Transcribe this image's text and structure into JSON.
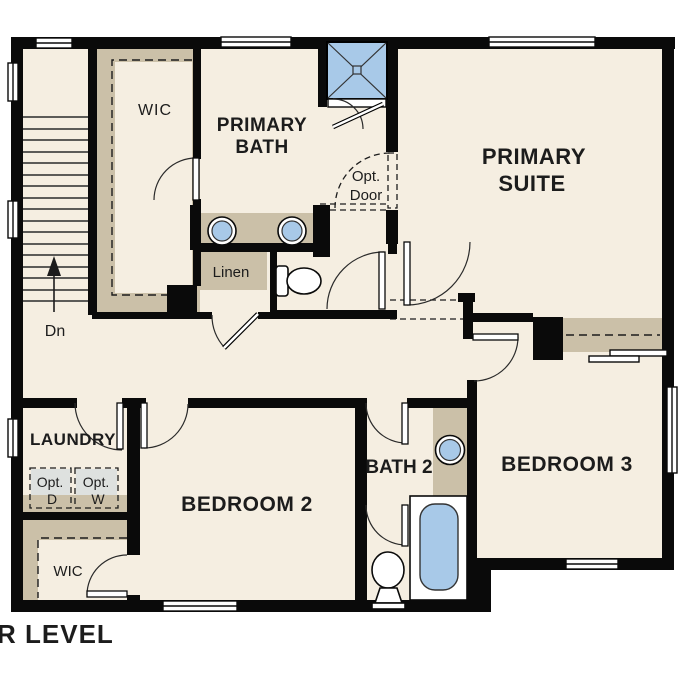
{
  "title": "UPPER LEVEL",
  "colors": {
    "bg": "#ffffff",
    "floor": "#f5eee1",
    "closet": "#cbc0a8",
    "fixture": "#a8c9e8",
    "wall": "#0a0a0a",
    "optional_fill": "#dee1df",
    "text": "#1c1c1c"
  },
  "rooms": {
    "wic_upper": {
      "label": "WIC"
    },
    "primary_bath": {
      "line1": "PRIMARY",
      "line2": "BATH"
    },
    "primary_suite": {
      "line1": "PRIMARY",
      "line2": "SUITE"
    },
    "opt_door": {
      "line1": "Opt.",
      "line2": "Door"
    },
    "linen": {
      "label": "Linen"
    },
    "laundry": {
      "label": "LAUNDRY"
    },
    "opt_dryer": {
      "line1": "Opt.",
      "line2": "D"
    },
    "opt_washer": {
      "line1": "Opt.",
      "line2": "W"
    },
    "bedroom2": {
      "label": "BEDROOM 2"
    },
    "bath2": {
      "label": "BATH 2"
    },
    "bedroom3": {
      "label": "BEDROOM 3"
    },
    "wic_lower": {
      "label": "WIC"
    },
    "stairs": {
      "label": "Dn"
    }
  }
}
